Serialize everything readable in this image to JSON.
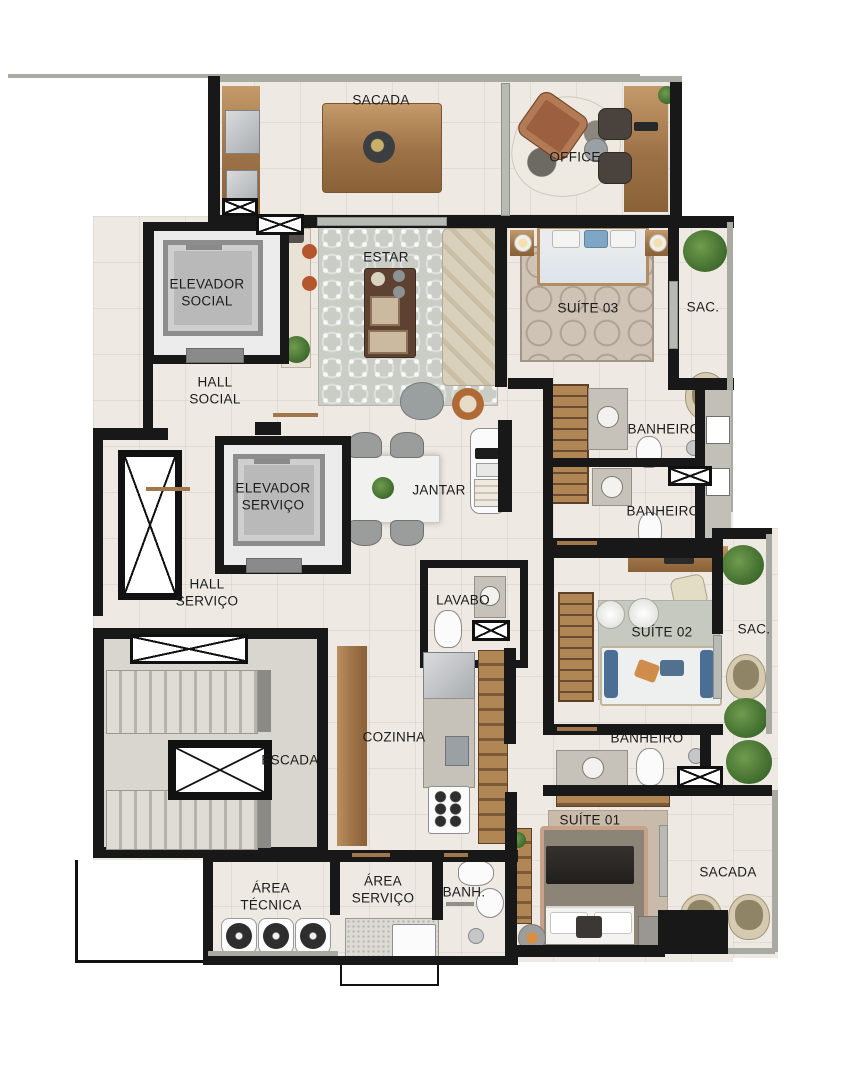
{
  "plan_title": "Apartment floor plan",
  "rooms": {
    "sacada_top": "SACADA",
    "office": "OFFICE",
    "elevador_social": "ELEVADOR\nSOCIAL",
    "estar": "ESTAR",
    "suite03": "SUÍTE 03",
    "sac_top": "SAC.",
    "hall_social": "HALL\nSOCIAL",
    "banheiro_suite03": "BANHEIRO",
    "elevador_servico": "ELEVADOR\nSERVIÇO",
    "jantar": "JANTAR",
    "banheiro_social": "BANHEIRO",
    "hall_servico": "HALL\nSERVIÇO",
    "lavabo": "LAVABO",
    "suite02": "SUÍTE 02",
    "sac_mid": "SAC.",
    "escada": "ESCADA",
    "cozinha": "COZINHA",
    "banheiro_suite01": "BANHEIRO",
    "suite01": "SUÍTE 01",
    "sacada_suite01": "SACADA",
    "area_tecnica": "ÁREA\nTÉCNICA",
    "area_servico": "ÁREA\nSERVIÇO",
    "banh": "BANH."
  },
  "colors": {
    "wall": "#181818",
    "floor": "#efe9e3",
    "concrete": "#d8d6cf",
    "railing": "#a9aba2",
    "wood": "#9c7146",
    "rug_gray": "#c9cdc5",
    "rug_tan": "#cfc3b6",
    "plant_green": "#3f6b2d",
    "label_text": "#1b1b1b"
  }
}
